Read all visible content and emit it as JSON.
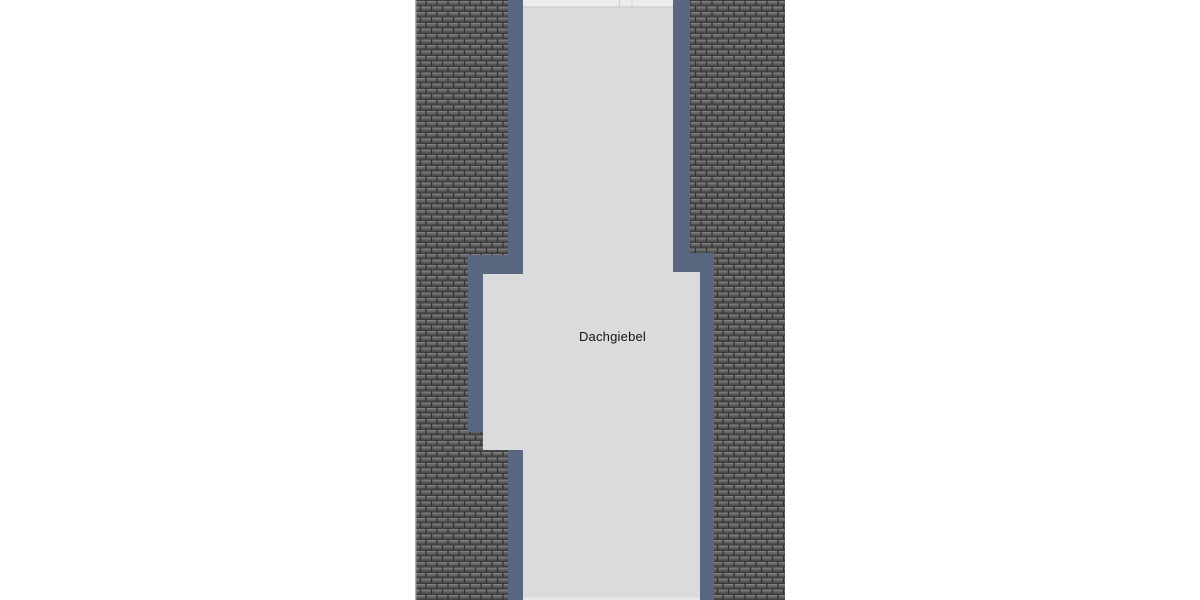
{
  "drawing": {
    "label": "Dachgiebel",
    "colors": {
      "page_background": "#ffffff",
      "tile_face": "#666666",
      "tile_dark_line": "#3a3a3a",
      "tile_highlight": "#828282",
      "tile_shadow": "#4d4d4d",
      "tile_gap": "#323232",
      "border_blue": "#5a6780",
      "gable_gray": "#dbdbdb",
      "ridge_light": "#ececec",
      "ridge_line": "#c9c9c9",
      "bottom_edge_light": "#e9e9e9",
      "label_text": "#141414"
    }
  }
}
